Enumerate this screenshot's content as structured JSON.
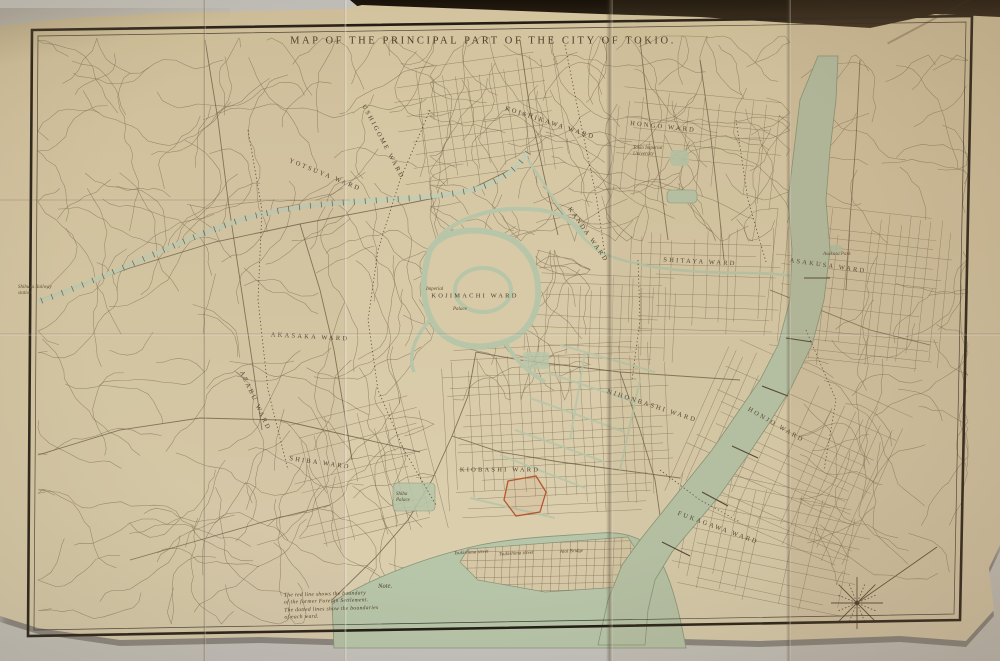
{
  "map": {
    "title": "MAP OF THE PRINCIPAL PART OF THE CITY OF TOKIO.",
    "note": {
      "heading": "Note.",
      "lines": [
        "The red line shows the boundary",
        "of the former Foreign Settlement.",
        "The dotted lines show the boundaries",
        "of each ward."
      ]
    },
    "wards": [
      {
        "label": "USHIGOME WARD",
        "x": 383,
        "y": 142,
        "rot": 62
      },
      {
        "label": "YOTSUYA WARD",
        "x": 325,
        "y": 175,
        "rot": 22
      },
      {
        "label": "KOISHIKAWA WARD",
        "x": 550,
        "y": 123,
        "rot": 18
      },
      {
        "label": "HONGO WARD",
        "x": 663,
        "y": 127,
        "rot": 6
      },
      {
        "label": "KANDA WARD",
        "x": 588,
        "y": 235,
        "rot": 55
      },
      {
        "label": "SHITAYA WARD",
        "x": 700,
        "y": 262,
        "rot": 3
      },
      {
        "label": "ASAKUSA WARD",
        "x": 828,
        "y": 266,
        "rot": 8
      },
      {
        "label": "KOJIMACHI WARD",
        "x": 475,
        "y": 296,
        "rot": 0
      },
      {
        "label": "AKASAKA WARD",
        "x": 310,
        "y": 337,
        "rot": 3
      },
      {
        "label": "AZABU WARD",
        "x": 255,
        "y": 401,
        "rot": 65
      },
      {
        "label": "SHIBA WARD",
        "x": 320,
        "y": 463,
        "rot": 8
      },
      {
        "label": "KIOBASHI WARD",
        "x": 500,
        "y": 470,
        "rot": 0
      },
      {
        "label": "NIHONBASHI WARD",
        "x": 652,
        "y": 406,
        "rot": 18
      },
      {
        "label": "HONJO WARD",
        "x": 776,
        "y": 425,
        "rot": 30
      },
      {
        "label": "FUKAGAWA WARD",
        "x": 718,
        "y": 528,
        "rot": 20
      }
    ],
    "places": [
      {
        "label": "Imperial",
        "x": 441,
        "y": 290,
        "rot": 0,
        "w": 30
      },
      {
        "label": "Palace",
        "x": 466,
        "y": 310,
        "rot": 0,
        "w": 26
      },
      {
        "label": "Tokio Imperial University",
        "x": 648,
        "y": 152,
        "rot": 0,
        "w": 30
      },
      {
        "label": "Asakusa Park",
        "x": 837,
        "y": 255,
        "rot": 0,
        "w": 28
      },
      {
        "label": "Shiba Palace",
        "x": 409,
        "y": 498,
        "rot": 0,
        "w": 26
      },
      {
        "label": "Shibuya Railway station",
        "x": 36,
        "y": 291,
        "rot": 0,
        "w": 36
      },
      {
        "label": "Tsukishima street",
        "x": 484,
        "y": 553,
        "rot": -3,
        "w": 60
      },
      {
        "label": "Tsukishima street",
        "x": 529,
        "y": 554,
        "rot": -3,
        "w": 60
      },
      {
        "label": "Aioi Bridge",
        "x": 580,
        "y": 552,
        "rot": -3,
        "w": 40
      }
    ],
    "colors": {
      "paper": "#d6c8a5",
      "ink": "#7d6e55",
      "road": "#6b5d45",
      "water": "#b7c5a9",
      "water_edge": "#86957a",
      "frame": "#241e16",
      "red_line": "#b5572e",
      "boundary": "#403525"
    }
  }
}
